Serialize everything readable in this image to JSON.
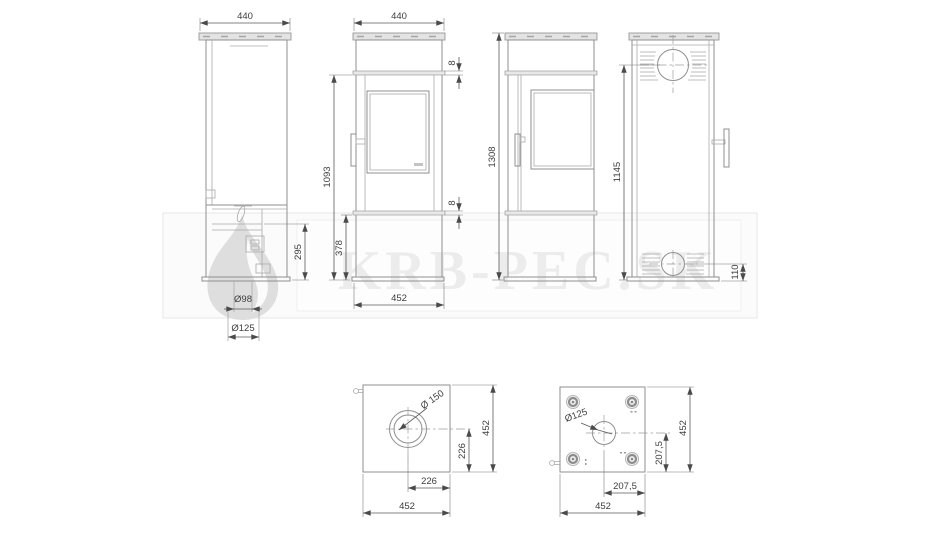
{
  "watermark": {
    "text": "KRB-PEC.SK"
  },
  "dims": {
    "side": {
      "width": "440",
      "lower_height": "295",
      "flue_stub": "Ø98",
      "adapter": "Ø125"
    },
    "front_a": {
      "width": "440",
      "ledge_top": "8",
      "ledge_bottom": "8",
      "door_height": "1093",
      "base_height": "378",
      "base_width": "452"
    },
    "front_b": {
      "total_height": "1308"
    },
    "rear": {
      "flue_center_height": "1145",
      "inlet_center_height": "110"
    },
    "top": {
      "flue_diameter": "Ø 150",
      "offset_y": "226",
      "depth": "452",
      "offset_x": "226",
      "width": "452"
    },
    "bottom": {
      "inlet_diameter": "Ø125",
      "offset_y": "207,5",
      "depth": "452",
      "offset_x": "207,5",
      "width": "452"
    }
  }
}
